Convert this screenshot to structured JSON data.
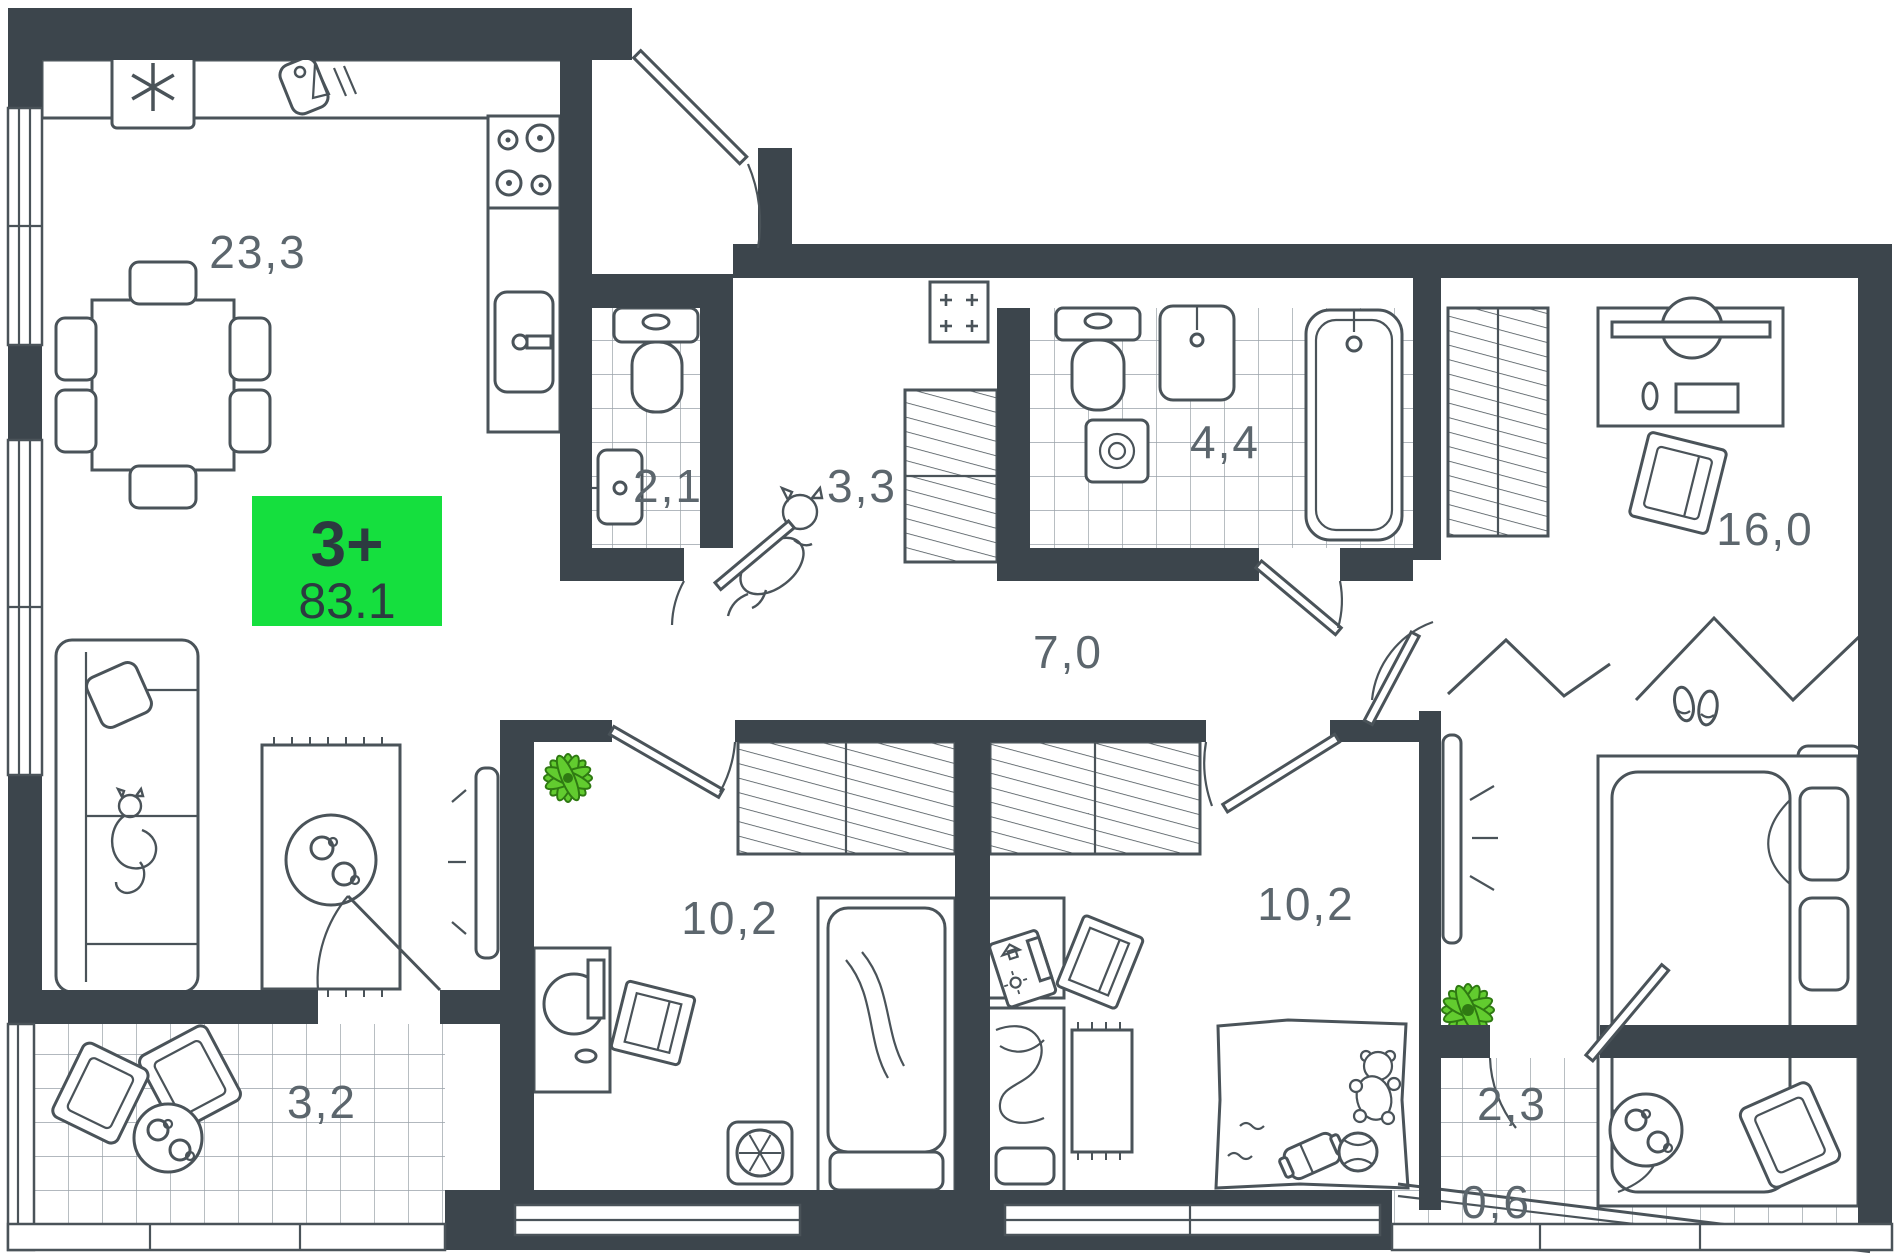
{
  "badge": {
    "type": "3+",
    "area": "83.1",
    "color": "#15DF3E",
    "text_color": "#2C3A40"
  },
  "rooms": [
    {
      "name": "kitchen-living-room",
      "area": "23,3"
    },
    {
      "name": "bathroom-small",
      "area": "2,1"
    },
    {
      "name": "entry-hall",
      "area": "3,3"
    },
    {
      "name": "bathroom-main",
      "area": "4,4"
    },
    {
      "name": "corridor",
      "area": "7,0"
    },
    {
      "name": "bedroom-left",
      "area": "10,2"
    },
    {
      "name": "bedroom-middle",
      "area": "10,2"
    },
    {
      "name": "bedroom-master",
      "area": "16,0"
    },
    {
      "name": "loggia-left",
      "area": "3,2"
    },
    {
      "name": "loggia-right",
      "area": "2,3"
    },
    {
      "name": "loggia-right-cold",
      "area": "0,6"
    }
  ],
  "colors": {
    "wall": "#3C454C",
    "furniture_line": "#4A5359",
    "tile_line": "#99A1A8",
    "label_text": "#5C666D",
    "plant_leaf": "#62CC2F",
    "plant_outline": "#2F7A12"
  },
  "icons": {
    "fridge": "asterisk-snowflake-icon",
    "kitchen": "cutting-board-knife-icon",
    "electric_panel": "plus-grid-icon",
    "ac_units": "fan-icon",
    "heater": "radiator-rays-icon"
  }
}
